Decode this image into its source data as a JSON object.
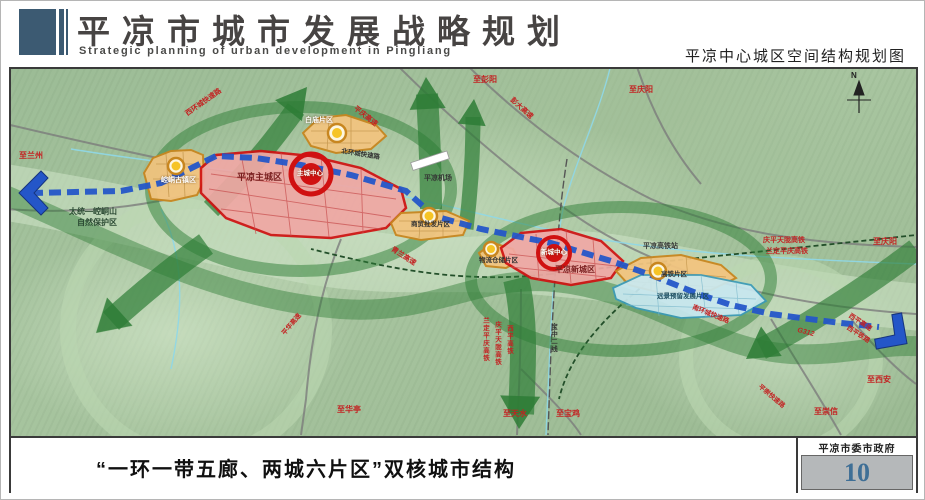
{
  "header": {
    "title": "平凉市城市发展战略规划",
    "subtitle": "Strategic planning of urban development in Pingliang",
    "map_title": "平凉中心城区空间结构规划图"
  },
  "footer": {
    "caption": "“一环一带五廊、两城六片区”双核城市结构",
    "org": "平凉市委市政府",
    "page_number": "10"
  },
  "map": {
    "compass_n": "N",
    "zones": {
      "kongtong": "崆峒古镇区",
      "baimiao": "白庙片区",
      "main_city": "平凉主城区",
      "trade": "商贸批发片区",
      "logistics": "物流仓储片区",
      "new_city": "平凉新城区",
      "hsr": "高铁片区",
      "reserve": "远景预留发展片区"
    },
    "centers": {
      "main": "主城中心",
      "new": "新城中心"
    },
    "nature_reserve_line1": "太统—崆峒山",
    "nature_reserve_line2": "自然保护区",
    "facilities": {
      "airport": "平凉机场",
      "hsr_station": "平凉高铁站"
    },
    "roads": {
      "west_ring": "西环城快速路",
      "north_ring": "北环城快速路",
      "south_ring": "南环城快速路",
      "pingqing": "平庆高速",
      "pengda": "彭大高速",
      "qinglan": "青兰高速",
      "pinghua": "平华高速",
      "pingchong": "平崇快速路",
      "xiping_exp": "西平高速",
      "xiping_rail": "西平铁路",
      "g312": "G312"
    },
    "rails": {
      "qingpingtianlong": "庆平天陇高铁",
      "landingpingqing": "兰定平庆高铁",
      "xiping_hsr": "西平高铁",
      "baozhong": "宝中二线"
    },
    "directions": {
      "lanzhou": "至兰州",
      "pengyang": "至彭阳",
      "qingyang": "至庆阳",
      "xian": "至西安",
      "chongxin": "至崇信",
      "huating": "至华亭",
      "tianshui": "至天水",
      "baoji": "至宝鸡"
    },
    "colors": {
      "corridor_green": "#2e7d36",
      "city_red": "#d01111",
      "zone_orange": "#c8861f",
      "reserve_blue": "#3a9ab8",
      "transit_blue": "#2456c8"
    }
  }
}
